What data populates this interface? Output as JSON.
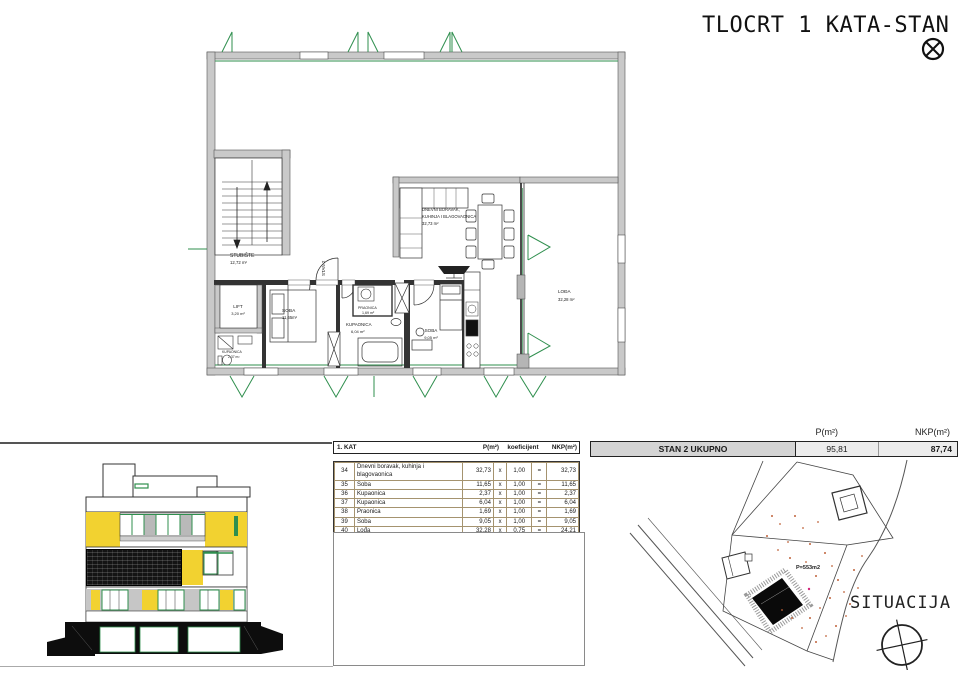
{
  "header": {
    "title": "TLOCRT 1 KATA-STAN 2"
  },
  "floor_plan": {
    "stairs": {
      "name": "STUBIŠTE",
      "area": "12,72 m²"
    },
    "lift": {
      "name": "LIFT",
      "area": "3,20 m²"
    },
    "bath_small": {
      "name": "KUPAONICA",
      "area": "2,37 m²"
    },
    "bedroom1": {
      "name": "SOBA",
      "area": "11,65m²"
    },
    "laundry": {
      "name": "PRAONICA",
      "area": "1,69 m²"
    },
    "bath_large": {
      "name": "KUPAONICA",
      "area": "6,04 m²"
    },
    "bedroom2": {
      "name": "SOBA",
      "area": "9,05 m²"
    },
    "living": {
      "line1": "DNEVNI BORAVAK,",
      "line2": "KUHINJA I BLAGOVAONICA",
      "area": "32,73 m²"
    },
    "loggia": {
      "name": "LOĐA",
      "area": "32,28 m²"
    },
    "entry_label": "STAN 2"
  },
  "area_table": {
    "floor_label": "1. KAT",
    "col_p": "P(m²)",
    "col_koef": "koeficijent",
    "col_nkp": "NKP(m²)",
    "rows": [
      {
        "num": "34",
        "name": "Dnevni boravak, kuhinja i blagovaonica",
        "p": "32,73",
        "times": "x",
        "koef": "1,00",
        "eq": "=",
        "nkp": "32,73"
      },
      {
        "num": "35",
        "name": "Soba",
        "p": "11,65",
        "times": "x",
        "koef": "1,00",
        "eq": "=",
        "nkp": "11,65"
      },
      {
        "num": "36",
        "name": "Kupaonica",
        "p": "2,37",
        "times": "x",
        "koef": "1,00",
        "eq": "=",
        "nkp": "2,37"
      },
      {
        "num": "37",
        "name": "Kupaonica",
        "p": "6,04",
        "times": "x",
        "koef": "1,00",
        "eq": "=",
        "nkp": "6,04"
      },
      {
        "num": "38",
        "name": "Praonica",
        "p": "1,69",
        "times": "x",
        "koef": "1,00",
        "eq": "=",
        "nkp": "1,69"
      },
      {
        "num": "39",
        "name": "Soba",
        "p": "9,05",
        "times": "x",
        "koef": "1,00",
        "eq": "=",
        "nkp": "9,05"
      },
      {
        "num": "40",
        "name": "Lođa",
        "p": "32,28",
        "times": "x",
        "koef": "0,75",
        "eq": "=",
        "nkp": "24,21"
      }
    ],
    "total": {
      "label": "STAN 2 UKUPNO",
      "p": "95,81",
      "nkp": "87,74"
    }
  },
  "summary": {
    "col_p": "P(m²)",
    "col_nkp": "NKP(m²)",
    "label": "STAN 2 UKUPNO",
    "p": "95,81",
    "nkp": "87,74"
  },
  "site_plan": {
    "parcel_area": "P=553m2",
    "title": "SITUACIJA"
  },
  "colors": {
    "facade_yellow": "#f2d230",
    "window_green": "#2f8f4e",
    "wall_gray": "#c9c9c9",
    "site_dot_orange": "#c0633a"
  }
}
